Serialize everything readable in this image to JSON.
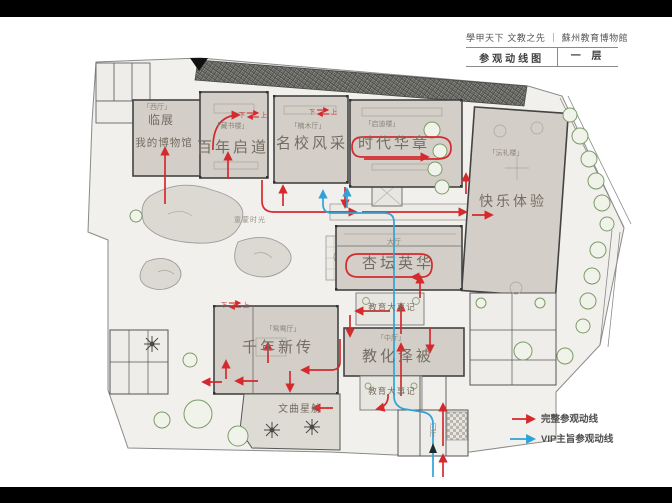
{
  "header": {
    "motto": "學甲天下 文教之先",
    "divider": "｜",
    "museum": "蘇州教育博物館",
    "sheet_title": "参观动线图",
    "floor_label": "一 层"
  },
  "legend": {
    "full_route_label": "完整参观动线",
    "vip_route_label": "VIP主旨参观动线",
    "full_route_color": "#d42a2e",
    "vip_route_color": "#2fa3d8"
  },
  "plan": {
    "halls": {
      "lin_zhan": "临展",
      "my_museum": "我的博物馆",
      "bainian_qidao": "百年启道",
      "mingxiao_fengcai": "名校风采",
      "shidai_huazhang": "时代华章",
      "kuaile_tiyan": "快乐体验",
      "xingtan_yinghua": "杏坛英华",
      "qiannian_xinchuan": "千年新传",
      "jiaohua_zebei": "教化泽被",
      "jiaoyu_dashiji": "教育大事记",
      "wenqu_xingfang": "文曲星舫"
    },
    "rooms": {
      "west_hall": "「西厅」",
      "cangshu_lou": "「藏书楼」",
      "nanmu_ting": "「楠木厅」",
      "qidi_lou": "「启迪楼」",
      "yunli_lou": "「沄礼楼」",
      "yuanyang_ting": "「鸳鸯厅」",
      "zhong_ting": "「中厅」",
      "da_ting": "大厅",
      "men_ting": "门厅",
      "tongmeng_shiguang": "童蒙时光"
    },
    "stairs": {
      "down": "下",
      "up": "上"
    }
  }
}
